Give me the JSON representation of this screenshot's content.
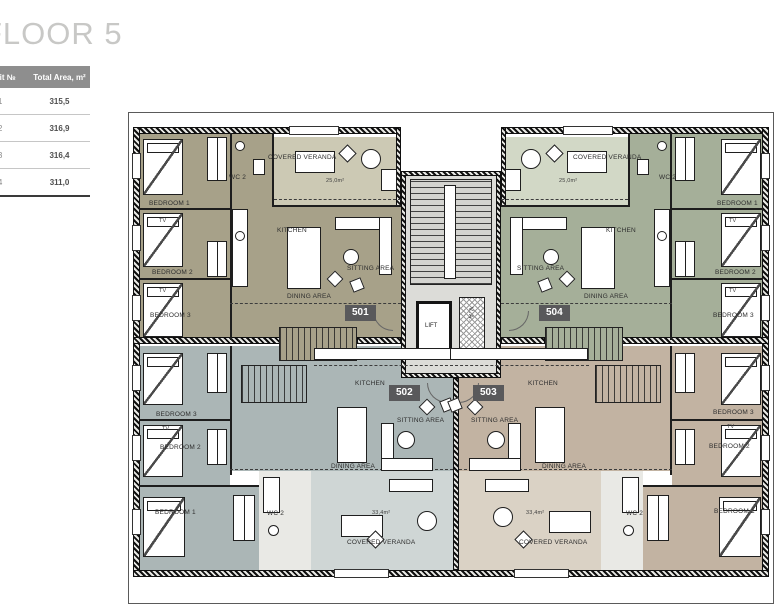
{
  "title": "FLOOR 5",
  "table": {
    "header": {
      "unit": "Unit №",
      "area": "Total Area, m²"
    },
    "rows": [
      {
        "unit": "501",
        "area": "315,5"
      },
      {
        "unit": "502",
        "area": "316,9"
      },
      {
        "unit": "503",
        "area": "316,4"
      },
      {
        "unit": "504",
        "area": "311,0"
      }
    ]
  },
  "core": {
    "lift": "LIFT",
    "shaft": "V.A."
  },
  "units": {
    "u501": {
      "number": "501",
      "kitchen": "KITCHEN",
      "sitting": "SITTING AREA",
      "dining": "DINING AREA",
      "veranda": "COVERED VERANDA",
      "veranda_area": "25,0m²",
      "wc": "WC 2",
      "bedroom1": "BEDROOM 1",
      "bedroom2": "BEDROOM 2",
      "bedroom3": "BEDROOM 3",
      "tv": "TV"
    },
    "u502": {
      "number": "502",
      "kitchen": "KITCHEN",
      "sitting": "SITTING AREA",
      "dining": "DINING AREA",
      "veranda": "COVERED VERANDA",
      "veranda_area": "33,4m²",
      "wc": "WC 2",
      "bedroom1": "BEDROOM 1",
      "bedroom2": "BEDROOM 2",
      "bedroom3": "BEDROOM 3",
      "tv": "TV"
    },
    "u503": {
      "number": "503",
      "kitchen": "KITCHEN",
      "sitting": "SITTING AREA",
      "dining": "DINING AREA",
      "veranda": "COVERED VERANDA",
      "veranda_area": "33,4m²",
      "wc": "WC 2",
      "bedroom1": "BEDROOM 1",
      "bedroom2": "BEDROOM 2",
      "bedroom3": "BEDROOM 3",
      "tv": "TV"
    },
    "u504": {
      "number": "504",
      "kitchen": "KITCHEN",
      "sitting": "SITTING AREA",
      "dining": "DINING AREA",
      "veranda": "COVERED VERANDA",
      "veranda_area": "25,0m²",
      "wc": "WC 2",
      "bedroom1": "BEDROOM 1",
      "bedroom2": "BEDROOM 2",
      "bedroom3": "BEDROOM 3",
      "tv": "TV"
    }
  },
  "colors": {
    "unit_501": "#a7a189",
    "unit_501_veranda": "#ccc9b4",
    "unit_502": "#abb6b6",
    "unit_502_veranda": "#cfd6d5",
    "unit_503": "#c2b3a2",
    "unit_503_veranda": "#dad2c5",
    "unit_504": "#a5af99",
    "unit_504_veranda": "#d2d8c6",
    "core": "#dcdcd8",
    "badge": "#59595b",
    "table_header": "#8e8e8e",
    "wall": "#111111"
  }
}
